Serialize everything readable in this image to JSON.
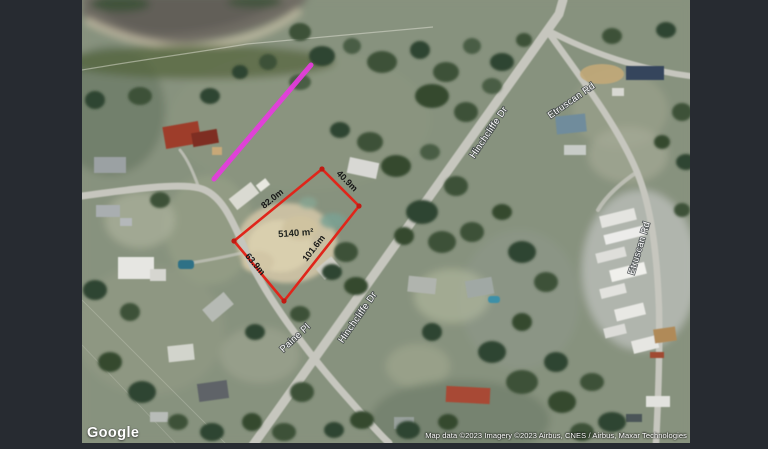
{
  "colors": {
    "letterbox": "#272b31",
    "parcel_outline": "#e0251a",
    "parcel_vertex": "#c11a12",
    "highlight_line": "#e73bdf",
    "road_label_text": "#ffffff",
    "measurement_text": "#161616"
  },
  "map": {
    "google_logo": "Google",
    "attribution": "Map data ©2023 Imagery ©2023 Airbus, CNES / Airbus, Maxar Technologies",
    "road_labels": [
      {
        "text": "Hinchcliffe Dr"
      },
      {
        "text": "Etruscan Rd"
      },
      {
        "text": "Etruscan Rd"
      },
      {
        "text": "Hinchcliffe Dr"
      },
      {
        "text": "Paine Pl"
      }
    ],
    "parcel": {
      "area_label": "5140 m²",
      "edge_labels": [
        "82.0m",
        "40.9m",
        "101.6m",
        "63.9m"
      ]
    }
  }
}
